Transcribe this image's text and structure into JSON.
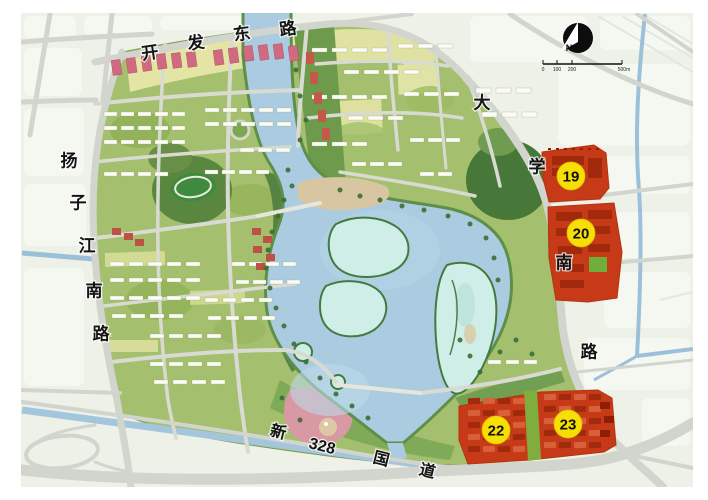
{
  "map": {
    "road_names": {
      "top": "开发东路",
      "left": "扬子江南路",
      "right": "大学南路",
      "bottom": "新328国道"
    },
    "road_labels": {
      "top": [
        "开",
        "发",
        "东",
        "路"
      ],
      "left": [
        "扬",
        "子",
        "江",
        "南",
        "路"
      ],
      "right": [
        "大",
        "学",
        "南",
        "路"
      ],
      "bottom": [
        "新",
        "328",
        "国",
        "道"
      ]
    },
    "parcel_markers": [
      {
        "label": "19"
      },
      {
        "label": "20"
      },
      {
        "label": "22"
      },
      {
        "label": "23"
      }
    ],
    "compass_label": "N",
    "scale_labels": [
      "0",
      "100",
      "200",
      "500m"
    ],
    "colors": {
      "parcel_red": "#c63a18",
      "parcel_building_red": "#a12a0c",
      "marker_yellow": "#f7df05",
      "water_blue": "#abcce0",
      "wetland_cyan": "#cfeee8",
      "site_green": "#a4bf6e",
      "road_gray": "#d2d5cd",
      "background": "#eef1e8"
    }
  }
}
